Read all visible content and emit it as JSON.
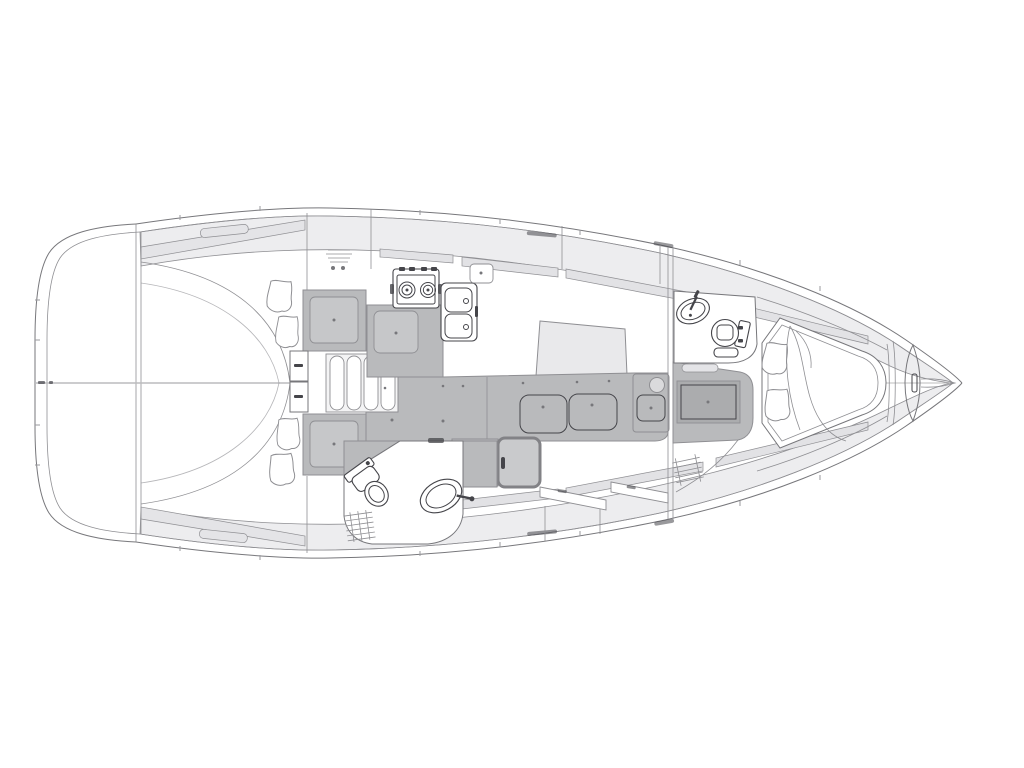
{
  "palette": {
    "background": "#ffffff",
    "line": "#77777b",
    "line_soft": "#8f8f93",
    "line_dark": "#45454a",
    "deck": "#ededef",
    "deck_strip": "#e4e4e7",
    "window": "#e2e2e5",
    "furniture": "#b9babc",
    "panel": "#c6c7c9",
    "panel_dark": "#abacae",
    "table": "#e9e9eb",
    "steps": "#f4f4f5"
  },
  "diagram": {
    "type": "diagram",
    "subject": "sailboat-interior-floor-plan-top-view",
    "orientation": {
      "bow": "right",
      "stern": "left"
    },
    "components": [
      "hull-outline",
      "side-decks",
      "cabin-windows",
      "deck-hatches",
      "aft-cabin-berth",
      "berth-pillows",
      "companionway-steps",
      "step-drawers",
      "storage-lockers",
      "galley-stove",
      "galley-sink",
      "galley-counter",
      "saloon-table",
      "saloon-settee",
      "fridge-box",
      "aft-head-toilet",
      "aft-head-washbasin",
      "shower-grate",
      "mid-cabin-berth",
      "forward-head-toilet",
      "forward-head-washbasin",
      "v-berth-bed",
      "bed-blanket",
      "bow-anchor-locker",
      "centerline"
    ]
  }
}
